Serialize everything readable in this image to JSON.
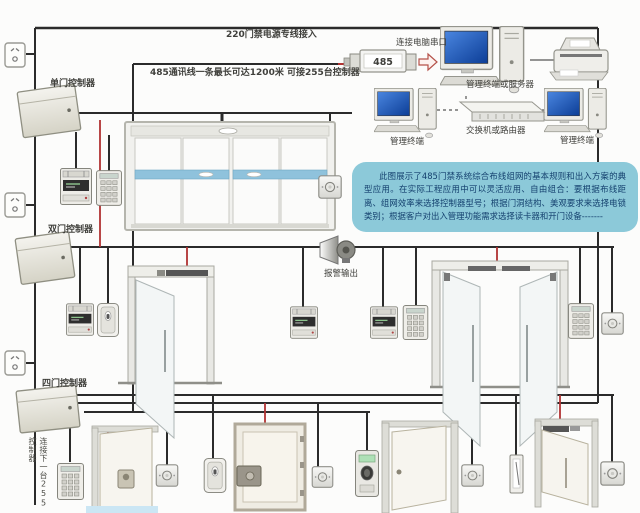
{
  "colors": {
    "background": "#fcfcfb",
    "wire": "#2b2b2b",
    "power_wire_red": "#b03232",
    "info_box_bg": "#8cc9d9",
    "info_box_text": "#14406e",
    "monitor_screen_blue": "#1e56b8",
    "door_glass_stripe_blue": "#8fc2dc",
    "label_text": "#40403c",
    "converter_red": "#c03030"
  },
  "labels": {
    "power_line": "220门禁电源专线接入",
    "rs485_line": "485通讯线一条最长可达1200米 可接255台控制器",
    "controller_single": "单门控制器",
    "controller_double": "双门控制器",
    "controller_quad": "四门控制器",
    "serial_port": "连接电脑串口",
    "converter": "485",
    "server": "管理终端或服务器",
    "terminal_left": "管理终端",
    "terminal_right": "管理终端",
    "switch": "交换机或路由器",
    "alarm_output": "报警输出",
    "next_controller": "连接下一台255控制器"
  },
  "info_box": {
    "text": "此图展示了485门禁系统综合布线组网的基本规则和出入方案的典型应用。在实际工程应用中可以灵活应用、自由组合：要根据布线距离、组网效率来选择控制器型号；根据门洞结构、美观要求来选择电锁类别；根据客户对出入管理功能需求选择读卡器和开门设备-------"
  },
  "icons": {
    "power-socket-icon": "rounded square wall socket with slanted pins",
    "door-controller-icon": "tilted metal controller cabinet",
    "card-reader-display-icon": "wall reader with dark LCD strip",
    "card-reader-icon": "plain wall reader with LED slot",
    "keypad-reader-icon": "wall keypad with 3x4 keys",
    "exit-button-icon": "square plate with round push button",
    "fingerprint-reader-icon": "reader with green display and oval sensor",
    "door-contact-icon": "narrow strip device",
    "alarm-siren-icon": "horn speaker",
    "sliding-door-icon": "automatic double sliding glass door with blue stripe",
    "glass-door-icon": "swing glass door with magnetic lock bar",
    "wood-door-icon": "wooden door leaf with lock",
    "magnetic-lock-icon": "dark bar on door header",
    "electric-lock-icon": "mortise lock block",
    "rs485-converter-icon": "RS485 converter module",
    "arrow-right-icon": "hollow right arrow",
    "computer-icon": "monitor, keyboard and tower",
    "switch-icon": "rack switch 3D box",
    "printer-icon": "desktop printer"
  }
}
